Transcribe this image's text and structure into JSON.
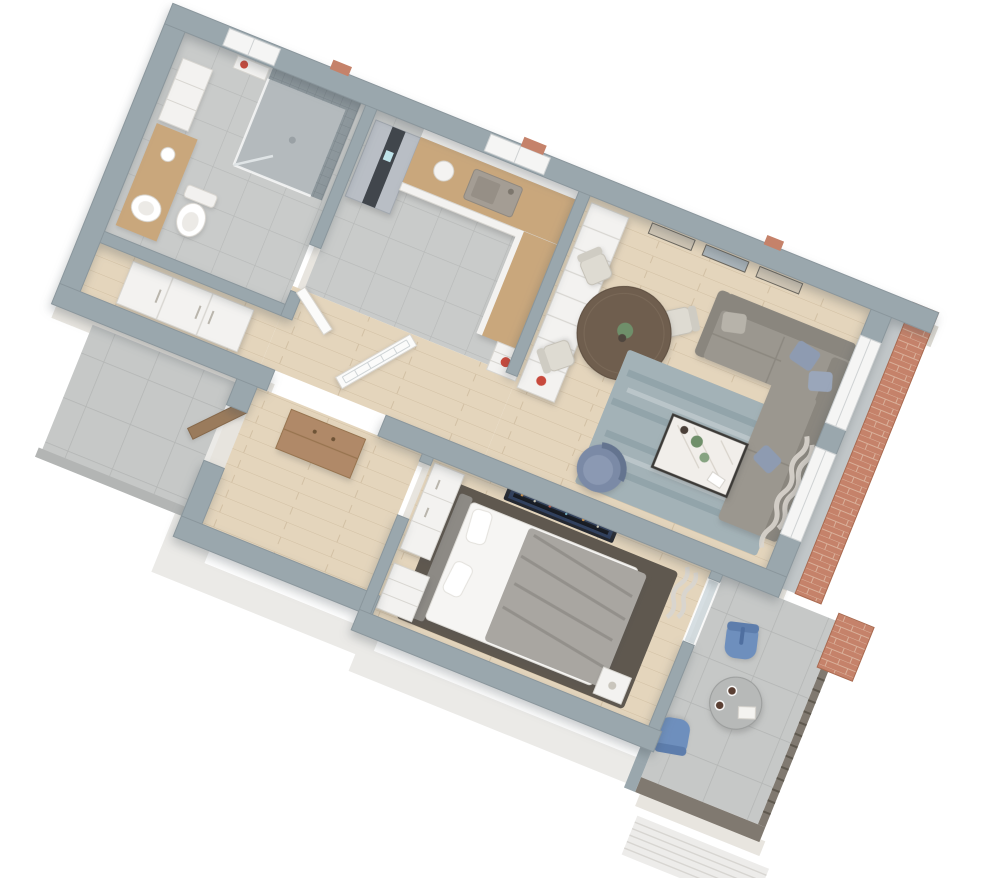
{
  "scene": {
    "type": "isometric-3d-floor-plan",
    "description": "Cutaway 3D render of a one-bedroom apartment, rotated ~22 degrees, white background",
    "rotation_degrees": 22,
    "background": "#ffffff"
  },
  "palette": {
    "wallTop": "#9aa7ad",
    "wallTopEdge": "#8a969c",
    "wallFace": "#d9d5ce",
    "wallFaceLight": "#e7e4de",
    "exteriorWhite": "#ebeae7",
    "brick": "#c5826a",
    "brickMortar": "#d9b09a",
    "sill": "#c2c7c9",
    "wood": "#e4d5bc",
    "woodLine": "#d2c0a4",
    "tileGray": "#c9cbca",
    "tileLine": "#b7b9b8",
    "concrete": "#c6c8c7",
    "concreteLine": "#b3b5b4",
    "showerTile": "#8d979c",
    "showerGrout": "#7d878c",
    "showerFloor": "#b4babd",
    "cabinetWhite": "#f3f2f0",
    "cabinetLine": "#d8d6d1",
    "counterWood": "#c9a77c",
    "walnut": "#b08968",
    "doorWood": "#9a7b5c",
    "fridgeSilver": "#b9bec5",
    "fridgeDark": "#41464c",
    "sinkMetal": "#a49d94",
    "sofa": "#9b978f",
    "sofaDark": "#8a867e",
    "pillowBlue": "#8e9bb1",
    "armchairBlue": "#7b8aa6",
    "rug": "#a3b2b7",
    "rugStreak": "#7e929b",
    "tableWood": "#6f5e4e",
    "chairBeige": "#dedbd2",
    "chairEdge": "#c6c2b8",
    "marble": "#f1eeea",
    "metalDark": "#3c3a37",
    "bedWhite": "#f6f5f3",
    "blanket": "#a9a6a1",
    "blanketFold": "#93908b",
    "bedRug": "#5f584f",
    "headboard": "#8d8a85",
    "tvDark": "#23262e",
    "tvGlow": "#2e3e5e",
    "balconyChair": "#6e8fbd",
    "railing": "#807970",
    "slatWhite": "#edecea",
    "slatLine": "#d7d5d1",
    "accentRed": "#c8493c",
    "plantGreen": "#6f8f6a",
    "artBeige": "#cfc5b4",
    "artBlue": "#aab4ba",
    "glass": "#cfd9dd"
  },
  "rooms": [
    {
      "id": "bathroom",
      "label": "Bathroom",
      "floor": "gray tile"
    },
    {
      "id": "hallway",
      "label": "Hallway",
      "floor": "wood"
    },
    {
      "id": "kitchen",
      "label": "Kitchen",
      "floor": "gray tile"
    },
    {
      "id": "living-dining",
      "label": "Living / Dining room",
      "floor": "light oak planks"
    },
    {
      "id": "vestibule",
      "label": "Entry vestibule",
      "floor": "wood"
    },
    {
      "id": "bedroom",
      "label": "Bedroom",
      "floor": "light oak planks"
    },
    {
      "id": "balcony",
      "label": "Balcony",
      "floor": "concrete tile"
    },
    {
      "id": "entry-landing",
      "label": "Entry landing",
      "floor": "concrete tile"
    }
  ],
  "furniture": {
    "bathroom": [
      "walk-in shower with glass door",
      "wood vanity with round sink",
      "toilet",
      "wall niche with red vase"
    ],
    "kitchen": [
      "silver fridge with dark stripe",
      "white cabinets with wood countertop",
      "inset sink with faucet",
      "L-return counter",
      "open shelf end-cap with red vase"
    ],
    "hallway": [
      "white three-door wardrobe",
      "open glass-paned french door"
    ],
    "living_dining": [
      "round dark wood dining table",
      "potted plant",
      "4 beige dining chairs",
      "3 framed landscape pictures",
      "gray L-shaped corner sofa",
      "blue throw pillows",
      "white marble coffee table with black frame",
      "green vases and cups",
      "blue armchair",
      "blue-gray area rug",
      "curtains",
      "tall white bookcase with red vase",
      "2 windows"
    ],
    "vestibule": [
      "walnut entry console",
      "entry door"
    ],
    "bedroom": [
      "double bed with white linens and gray blanket",
      "dark area rug",
      "wall TV showing night skyline",
      "white wardrobe",
      "white drawer dresser",
      "nightstand",
      "curtain",
      "glass balcony door"
    ],
    "balcony": [
      "2 blue chairs",
      "round bistro table with cups and book",
      "metal railing",
      "brick pillar",
      "white slat parapet panel"
    ]
  },
  "counts": {
    "wall_pictures": 3,
    "dining_chairs": 4,
    "balcony_chairs": 2,
    "living_windows": 2
  }
}
